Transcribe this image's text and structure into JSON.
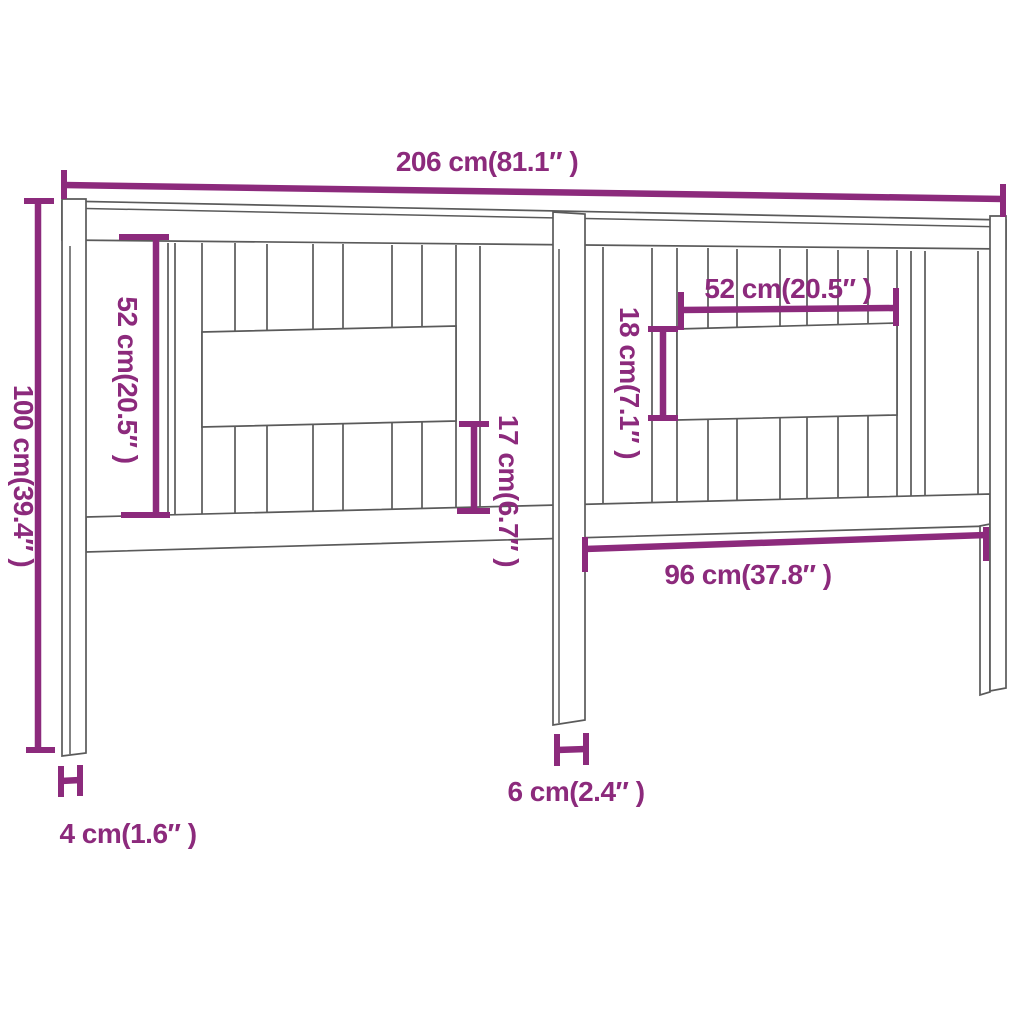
{
  "colors": {
    "dimension_accent": "#8C2A7C",
    "outline": "#5A5A5A",
    "background": "#FFFFFF"
  },
  "diagram": {
    "subject": "headboard-dimension-drawing",
    "dimensions": [
      {
        "id": "total-width",
        "label": "206 cm(81.1″ )",
        "orientation": "horizontal"
      },
      {
        "id": "total-height",
        "label": "100 cm(39.4″ )",
        "orientation": "vertical"
      },
      {
        "id": "left-slat-height",
        "label": "52 cm(20.5″ )",
        "orientation": "vertical"
      },
      {
        "id": "right-opening-width",
        "label": "52 cm(20.5″ )",
        "orientation": "horizontal"
      },
      {
        "id": "right-opening-height",
        "label": "18 cm(7.1″ )",
        "orientation": "vertical"
      },
      {
        "id": "left-lower-slat-height",
        "label": "17 cm(6.7″ )",
        "orientation": "vertical"
      },
      {
        "id": "right-section-width",
        "label": "96 cm(37.8″ )",
        "orientation": "horizontal"
      },
      {
        "id": "center-leg-width",
        "label": "6 cm(2.4″ )",
        "orientation": "horizontal"
      },
      {
        "id": "side-leg-depth",
        "label": "4 cm(1.6″ )",
        "orientation": "horizontal"
      }
    ]
  }
}
